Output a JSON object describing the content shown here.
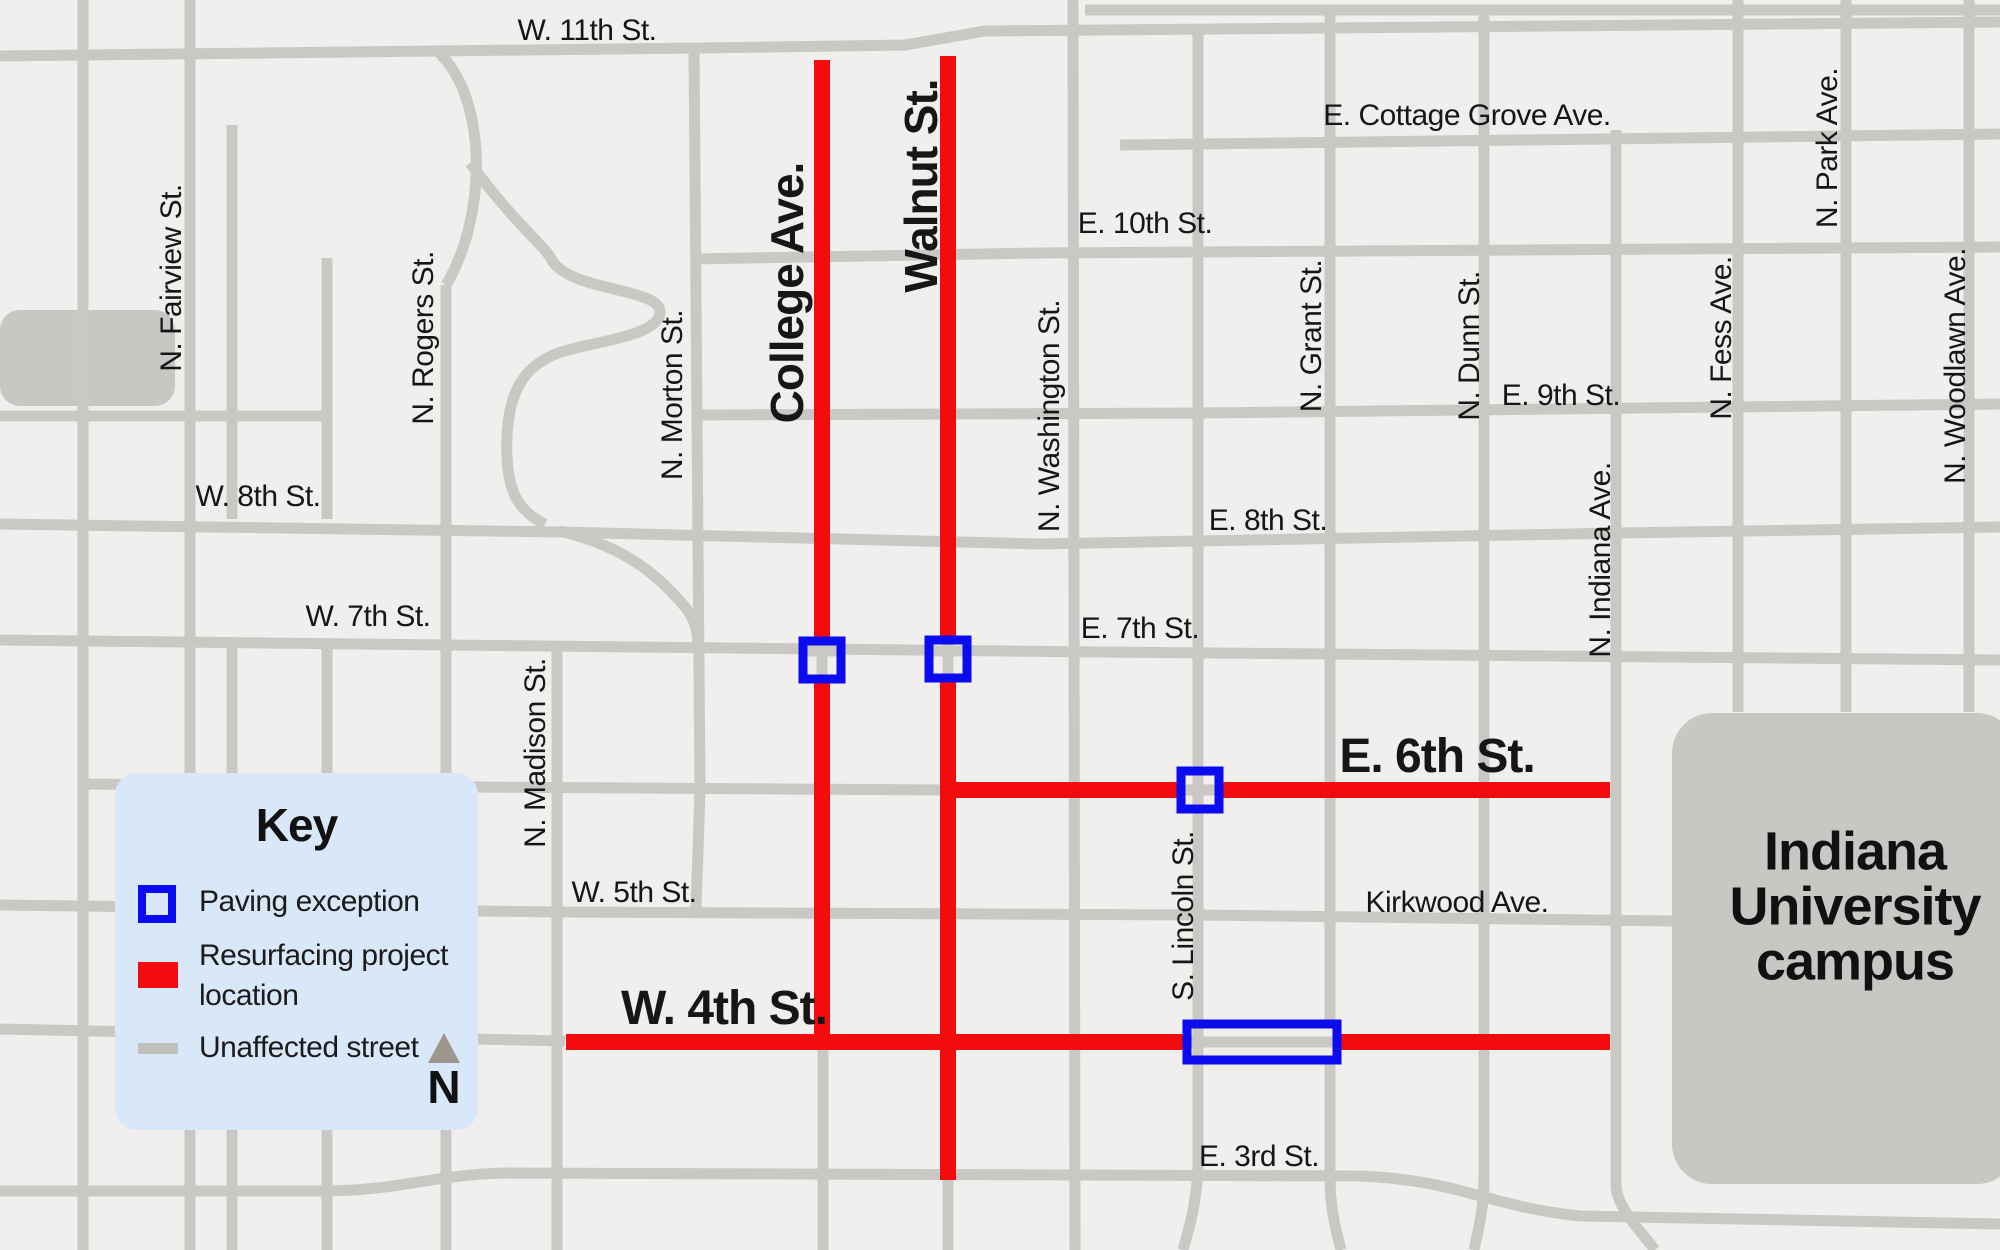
{
  "map": {
    "colors": {
      "background": "#f0efee",
      "street": "#cac8c5",
      "block": "#c9c7c4",
      "project_red": "#f40b0e",
      "exception_blue": "#0b0bf0",
      "label_text": "#161616"
    },
    "blocks": [
      {
        "name": "west-gray-block",
        "x": 0,
        "y": 310,
        "w": 175,
        "h": 96,
        "r": 20
      },
      {
        "name": "iu-campus-block",
        "x": 1672,
        "y": 713,
        "w": 345,
        "h": 471,
        "r": 40
      }
    ],
    "gray_streets": [
      "M1085,10 H2000",
      "M0,56 L700,48 L905,45 L985,31 L2000,22",
      "M1120,145 L2000,134",
      "M693,259 L1040,253 L2000,247",
      "M694,415 L1200,413 L2000,404",
      "M0,524 L560,532 L1040,544 L1620,533 L2000,527",
      "M0,640 L445,645 L1100,652 L2000,660",
      "M80,784 L478,787 L947,790",
      "M0,905 L557,912 L1198,915 L1672,921",
      "M0,1029 L565,1041",
      "M0,1191 L320,1191 C400,1191 430,1175 505,1173 L1360,1176 C1460,1180 1490,1207 1580,1216 L2000,1224",
      "M0,416 L327,416",
      "M83,0 V1250",
      "M190,0 V1250",
      "M232,125 V519",
      "M232,645 V1250",
      "M327,258 V519",
      "M327,645 V1250",
      "M446,285 V1250",
      "M436,50 C488,95 488,215 446,285",
      "M557,648 V1250",
      "M694,51 L700,790 L696,909",
      "M823,1046 V1250",
      "M948,1180 V1250",
      "M1073,0 L1075,1250",
      "M1198,30 V1172 C1195,1210 1189,1228 1183,1250",
      "M1330,10 V1176 C1330,1210 1336,1230 1341,1250",
      "M1484,10 V1176 C1484,1210 1478,1230 1474,1250",
      "M1616,130 V1184 C1616,1206 1638,1228 1655,1250",
      "M1738,0 V712",
      "M1846,0 V712",
      "M1969,0 V712",
      "M470,163 C520,230 545,245 553,262 C575,292 660,288 660,312 C660,334 605,340 568,350 C523,362 509,392 507,437 C505,488 516,510 545,524",
      "M560,531 C630,548 660,578 686,608 C697,622 698,636 698,648"
    ],
    "red_streets": [
      "M822,60 V1050",
      "M948,56 V1180",
      "M950,790 H1610",
      "M566,1042 H1610"
    ],
    "paving_exceptions": [
      {
        "x": 803,
        "y": 641,
        "w": 38,
        "h": 38,
        "inner": [
          [
            803,
            651,
            841,
            651
          ],
          [
            822,
            641,
            822,
            679
          ]
        ]
      },
      {
        "x": 929,
        "y": 640,
        "w": 38,
        "h": 38,
        "inner": [
          [
            929,
            651,
            967,
            651
          ],
          [
            948,
            640,
            948,
            678
          ]
        ]
      },
      {
        "x": 1181,
        "y": 771,
        "w": 38,
        "h": 38,
        "inner": [
          [
            1181,
            790,
            1219,
            790
          ],
          [
            1198,
            771,
            1198,
            809
          ]
        ]
      },
      {
        "x": 1187,
        "y": 1024,
        "w": 150,
        "h": 36,
        "inner": [
          [
            1187,
            1042,
            1337,
            1042
          ],
          [
            1198,
            1024,
            1198,
            1060
          ]
        ]
      }
    ],
    "labels": [
      {
        "id": "w-11th",
        "text": "W. 11th St.",
        "x": 587,
        "y": 31,
        "rot": false,
        "style": "plain"
      },
      {
        "id": "n-fairview",
        "text": "N. Fairview St.",
        "x": 172,
        "y": 278,
        "rot": true,
        "style": "plain"
      },
      {
        "id": "n-rogers",
        "text": "N. Rogers St.",
        "x": 424,
        "y": 338,
        "rot": true,
        "style": "plain"
      },
      {
        "id": "n-morton",
        "text": "N. Morton St.",
        "x": 673,
        "y": 395,
        "rot": true,
        "style": "plain"
      },
      {
        "id": "college-ave",
        "text": "College Ave.",
        "x": 787,
        "y": 293,
        "rot": true,
        "style": "bigv"
      },
      {
        "id": "walnut-st",
        "text": "Walnut St.",
        "x": 921,
        "y": 186,
        "rot": true,
        "style": "bigv"
      },
      {
        "id": "e-cottage",
        "text": "E. Cottage Grove Ave.",
        "x": 1467,
        "y": 116,
        "rot": false,
        "style": "plain"
      },
      {
        "id": "e-10th",
        "text": "E. 10th St.",
        "x": 1145,
        "y": 224,
        "rot": false,
        "style": "plain"
      },
      {
        "id": "n-washington",
        "text": "N. Washington St.",
        "x": 1050,
        "y": 416,
        "rot": true,
        "style": "plain"
      },
      {
        "id": "n-grant",
        "text": "N. Grant St.",
        "x": 1312,
        "y": 336,
        "rot": true,
        "style": "plain"
      },
      {
        "id": "n-dunn",
        "text": "N. Dunn St.",
        "x": 1470,
        "y": 346,
        "rot": true,
        "style": "plain"
      },
      {
        "id": "e-9th",
        "text": "E. 9th St.",
        "x": 1561,
        "y": 396,
        "rot": false,
        "style": "plain"
      },
      {
        "id": "n-fess",
        "text": "N. Fess Ave.",
        "x": 1722,
        "y": 338,
        "rot": true,
        "style": "plain"
      },
      {
        "id": "n-park",
        "text": "N. Park Ave.",
        "x": 1828,
        "y": 148,
        "rot": true,
        "style": "plain"
      },
      {
        "id": "n-woodlawn",
        "text": "N. Woodlawn Ave.",
        "x": 1956,
        "y": 366,
        "rot": true,
        "style": "plain"
      },
      {
        "id": "w-8th",
        "text": "W. 8th St.",
        "x": 258,
        "y": 497,
        "rot": false,
        "style": "plain"
      },
      {
        "id": "e-8th",
        "text": "E. 8th St.",
        "x": 1268,
        "y": 521,
        "rot": false,
        "style": "plain"
      },
      {
        "id": "w-7th",
        "text": "W. 7th St.",
        "x": 368,
        "y": 617,
        "rot": false,
        "style": "plain"
      },
      {
        "id": "e-7th",
        "text": "E. 7th St.",
        "x": 1140,
        "y": 629,
        "rot": false,
        "style": "plain"
      },
      {
        "id": "n-indiana",
        "text": "N. Indiana Ave.",
        "x": 1601,
        "y": 560,
        "rot": true,
        "style": "plain"
      },
      {
        "id": "n-madison",
        "text": "N. Madison St.",
        "x": 536,
        "y": 753,
        "rot": true,
        "style": "plain"
      },
      {
        "id": "e-6th",
        "text": "E. 6th St.",
        "x": 1437,
        "y": 757,
        "rot": false,
        "style": "big"
      },
      {
        "id": "w-5th",
        "text": "W. 5th St.",
        "x": 634,
        "y": 893,
        "rot": false,
        "style": "plain"
      },
      {
        "id": "kirkwood",
        "text": "Kirkwood Ave.",
        "x": 1457,
        "y": 903,
        "rot": false,
        "style": "plain"
      },
      {
        "id": "s-lincoln",
        "text": "S. Lincoln St.",
        "x": 1184,
        "y": 916,
        "rot": true,
        "style": "plain"
      },
      {
        "id": "w-4th",
        "text": "W. 4th St.",
        "x": 724,
        "y": 1009,
        "rot": false,
        "style": "big"
      },
      {
        "id": "e-3rd",
        "text": "E. 3rd St.",
        "x": 1259,
        "y": 1157,
        "rot": false,
        "style": "plain"
      }
    ]
  },
  "key": {
    "title": "Key",
    "items": [
      {
        "id": "paving-exception",
        "label": "Paving exception"
      },
      {
        "id": "resurfacing-project",
        "label": "Resurfacing project location"
      },
      {
        "id": "unaffected-street",
        "label": "Unaffected street"
      }
    ],
    "compass_label": "N"
  },
  "campus": {
    "lines": [
      "Indiana",
      "University",
      "campus"
    ]
  }
}
